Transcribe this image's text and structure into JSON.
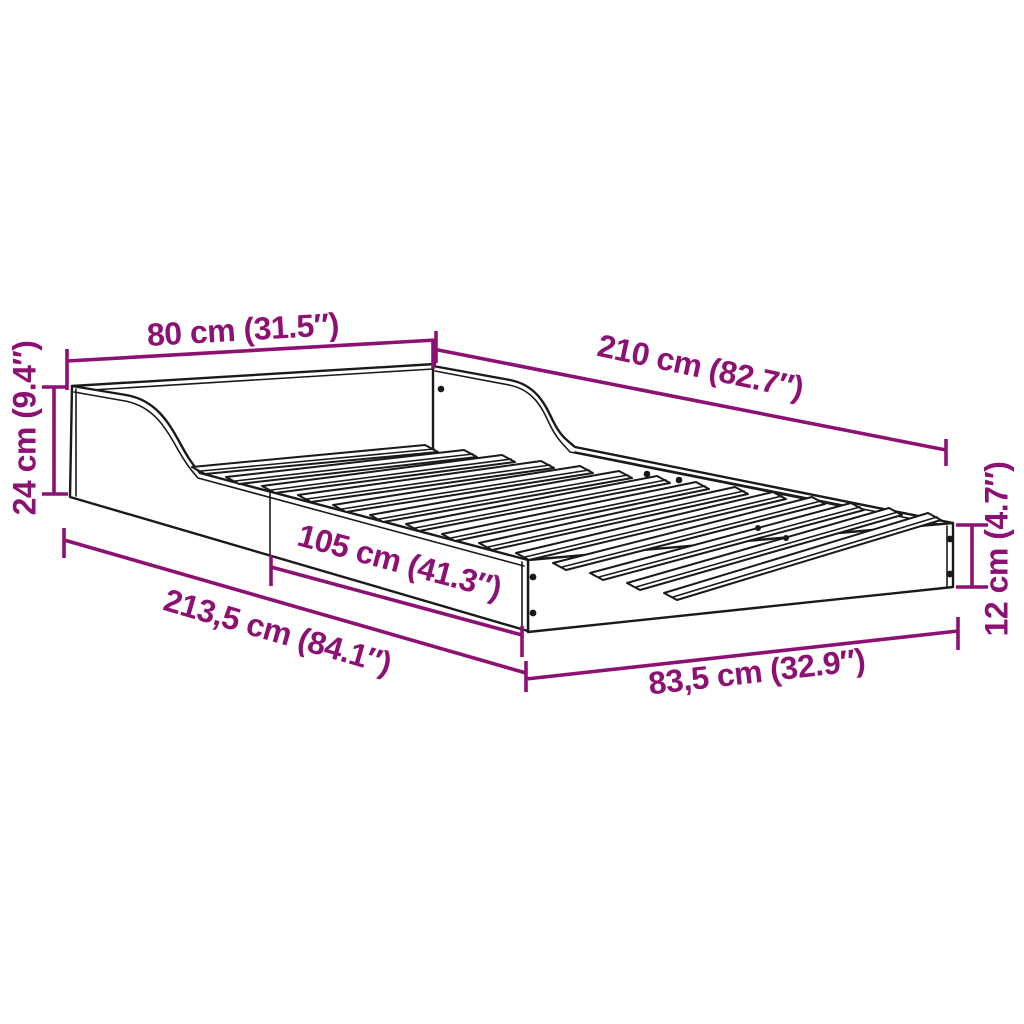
{
  "diagram": {
    "type": "product-dimension-diagram",
    "product": "bed frame with curved side rails and slatted base",
    "background_color": "#ffffff",
    "outline_color": "#1a1a1a",
    "dimension_color": "#8D1173",
    "slat_count": 14,
    "dimensions": {
      "top_width": "80 cm (31.5″)",
      "top_length": "210 cm (82.7″)",
      "head_height": "24 cm (9.4″)",
      "side_mid_length": "105 cm (41.3″)",
      "total_length": "213,5 cm (84.1″)",
      "foot_width": "83,5 cm (32.9″)",
      "foot_height": "12 cm (4.7″)"
    }
  }
}
